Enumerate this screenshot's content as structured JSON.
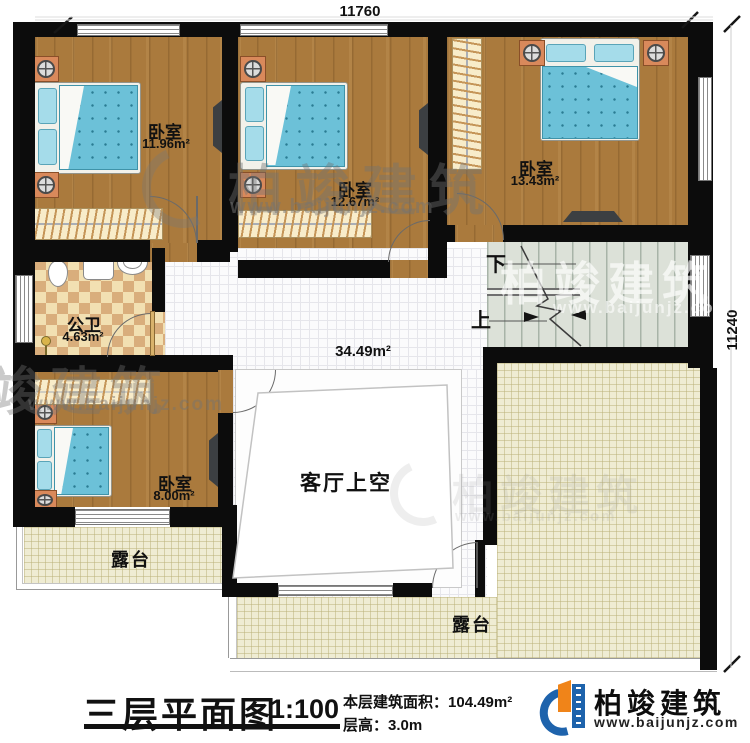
{
  "plan": {
    "dimensions": {
      "top_width": "11760",
      "right_height": "11240"
    },
    "rooms": {
      "bedroom_top_left": {
        "name": "卧室",
        "area": "11.96m²"
      },
      "bedroom_top_mid": {
        "name": "卧室",
        "area": "12.67m²"
      },
      "bedroom_top_right": {
        "name": "卧室",
        "area": "13.43m²"
      },
      "bedroom_bottom_left": {
        "name": "卧室",
        "area": "8.00m²"
      },
      "bathroom": {
        "name": "公卫",
        "area": "4.63m²"
      },
      "hall": {
        "area": "34.49m²"
      },
      "living_room_void": {
        "name": "客厅上空"
      },
      "terrace_left": {
        "name": "露台"
      },
      "terrace_right": {
        "name": "露台"
      }
    },
    "stairs": {
      "down_label": "下",
      "up_label": "上"
    }
  },
  "title_block": {
    "title": "三层平面图",
    "scale": "1:100",
    "area_label": "本层建筑面积：",
    "area_value": "104.49m²",
    "floor_height_label": "层高：",
    "floor_height_value": "3.0m"
  },
  "brand": {
    "name": "柏竣建筑",
    "website": "www.baijunjz.com"
  },
  "watermark": {
    "name": "柏竣建筑",
    "website": "www.baijunjz.com"
  },
  "colors": {
    "brand_blue": "#1e63ac",
    "brand_orange": "#f08419",
    "wall": "#0c0c0c",
    "wood": "#aa7a3d",
    "bed": "#6cc1d8"
  }
}
